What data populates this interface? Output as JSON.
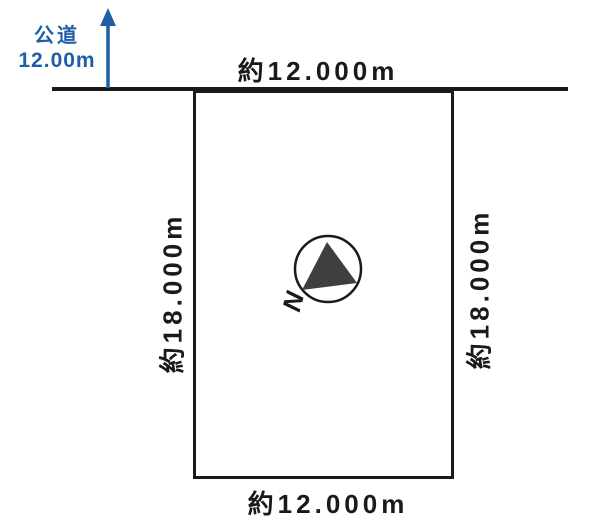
{
  "road": {
    "name": "公道",
    "width": "12.00m"
  },
  "plot": {
    "dimension_top": "約12.000m",
    "dimension_bottom": "約12.000m",
    "dimension_left": "約18.000m",
    "dimension_right": "約18.000m"
  },
  "compass": {
    "north_label": "N"
  },
  "colors": {
    "line_black": "#1a1a1a",
    "road_accent_blue": "#1e5fa8",
    "compass_needle_gray": "#3f3f3f",
    "background": "#ffffff"
  }
}
